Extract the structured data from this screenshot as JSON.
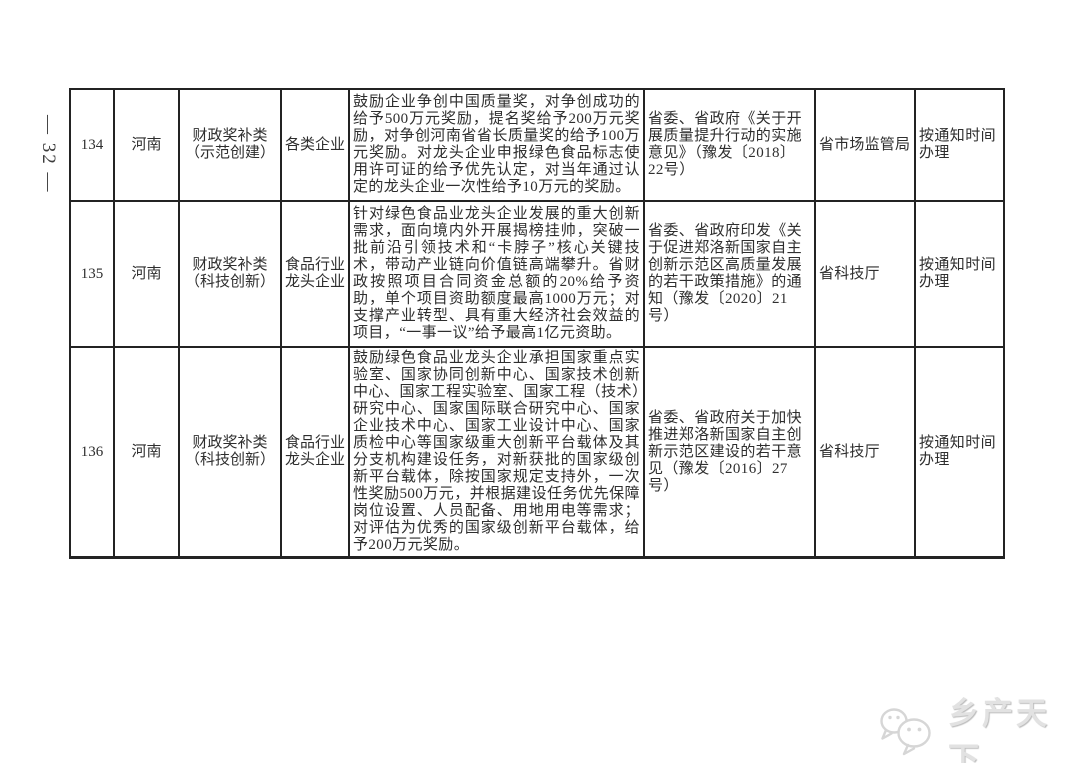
{
  "page": {
    "number": "— 32 —"
  },
  "table": {
    "rows": [
      {
        "index": "134",
        "province": "河南",
        "category": "财政奖补类\n（示范创建）",
        "target": "各类企业",
        "content": "鼓励企业争创中国质量奖，对争创成功的给予500万元奖励，提名奖给予200万元奖励，对争创河南省省长质量奖的给予100万元奖励。对龙头企业申报绿色食品标志使用许可证的给予优先认定，对当年通过认定的龙头企业一次性给予10万元的奖励。",
        "basis": "省委、省政府《关于开展质量提升行动的实施意见》（豫发〔2018〕22号）",
        "department": "省市场监管局",
        "time": "按通知时间办理"
      },
      {
        "index": "135",
        "province": "河南",
        "category": "财政奖补类\n（科技创新）",
        "target": "食品行业\n龙头企业",
        "content": "针对绿色食品业龙头企业发展的重大创新需求，面向境内外开展揭榜挂帅，突破一批前沿引领技术和“卡脖子”核心关键技术，带动产业链向价值链高端攀升。省财政按照项目合同资金总额的20%给予资助，单个项目资助额度最高1000万元；对支撑产业转型、具有重大经济社会效益的项目，“一事一议”给予最高1亿元资助。",
        "basis": "省委、省政府印发《关于促进郑洛新国家自主创新示范区高质量发展的若干政策措施》的通知（豫发〔2020〕21号）",
        "department": "省科技厅",
        "time": "按通知时间办理"
      },
      {
        "index": "136",
        "province": "河南",
        "category": "财政奖补类\n（科技创新）",
        "target": "食品行业\n龙头企业",
        "content": "鼓励绿色食品业龙头企业承担国家重点实验室、国家协同创新中心、国家技术创新中心、国家工程实验室、国家工程（技术）研究中心、国家国际联合研究中心、国家企业技术中心、国家工业设计中心、国家质检中心等国家级重大创新平台载体及其分支机构建设任务，对新获批的国家级创新平台载体，除按国家规定支持外，一次性奖励500万元，并根据建设任务优先保障岗位设置、人员配备、用地用电等需求；对评估为优秀的国家级创新平台载体，给予200万元奖励。",
        "basis": "省委、省政府关于加快推进郑洛新国家自主创新示范区建设的若干意见（豫发〔2016〕27号）",
        "department": "省科技厅",
        "time": "按通知时间办理"
      }
    ]
  },
  "watermark": {
    "text": "乡产天下",
    "icon_color": "#d6d6d6"
  }
}
